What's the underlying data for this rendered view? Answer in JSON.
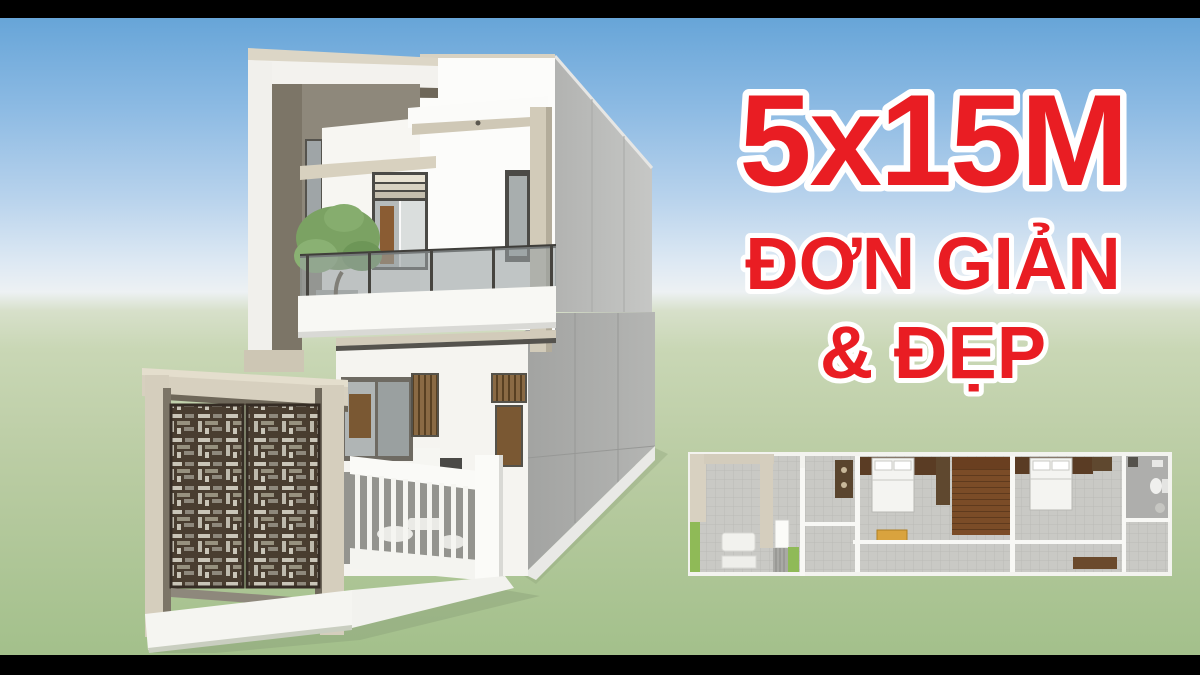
{
  "overlay_text": {
    "headline": "5x15M",
    "tagline_line1": "ĐƠN GIẢN",
    "tagline_line2": "& ĐẸP",
    "color": "#e91d23",
    "outline_color": "#ffffff"
  },
  "scene": {
    "letterbox_color": "#000000",
    "sky_top_color": "#67a5d8",
    "sky_horizon_color": "#edf1f3",
    "ground_top_color": "#d7e0ca",
    "ground_bottom_color": "#a3c08b"
  },
  "house_palette": {
    "wall_white": "#fbfbf8",
    "accent_beige": "#d6cfbe",
    "shadow_taupe": "#877f72",
    "side_wall_gray": "#b7b8b6",
    "gate_wood_dark": "#493d30",
    "window_frame_dark": "#4b4a46",
    "door_wood_brown": "#8a5c33",
    "tree_green": "#7ba263",
    "glass_gray": "#9aa3a4"
  },
  "floor_plan_palette": {
    "border_white": "#f3f3ef",
    "tile_gray": "#c9c9c5",
    "wall_beige": "#d6cfbf",
    "stairs_brown": "#7b4c27",
    "headboard_brown": "#5a3c24",
    "bed_white": "#f4f4f1",
    "bench_yellow": "#d9a33e",
    "planter_green": "#8fba57",
    "bathroom_gray": "#aeaeac"
  }
}
